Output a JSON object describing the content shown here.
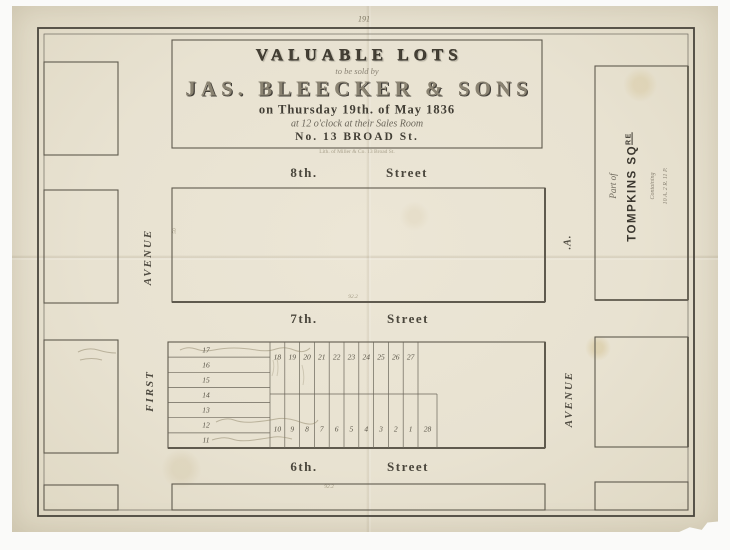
{
  "page_number": "191",
  "title_block": {
    "headline": "VALUABLE LOTS",
    "subline": "to be sold by",
    "auctioneer": "JAS. BLEECKER & SONS",
    "date_line": "on Thursday 19th. of May 1836",
    "time_line": "at 12 o'clock at their Sales Room",
    "address_line": "No. 13 BROAD St.",
    "imprint": "Lith. of Miller & Co. 13 Broad St."
  },
  "streets": {
    "s8": {
      "ordinal": "8th.",
      "word": "Street"
    },
    "s7": {
      "ordinal": "7th.",
      "word": "Street"
    },
    "s6": {
      "ordinal": "6th.",
      "word": "Street"
    }
  },
  "avenues": {
    "first_name": "FIRST",
    "first_word": "AVENUE",
    "a_word": "AVENUE",
    "a_name": ".A."
  },
  "square": {
    "part_of": "Part of",
    "name": "TOMPKINS SQ",
    "name_sup": "RE",
    "containing": "Containing",
    "area": "10 A. 2 R. 11 P."
  },
  "lots": {
    "west_column": [
      "17",
      "16",
      "15",
      "14",
      "13",
      "12",
      "11"
    ],
    "north_row": [
      "18",
      "19",
      "20",
      "21",
      "22",
      "23",
      "24",
      "25",
      "26",
      "27"
    ],
    "south_row": [
      "10",
      "9",
      "8",
      "7",
      "6",
      "5",
      "4",
      "3",
      "2",
      "1"
    ],
    "corner_lot": "28"
  },
  "dimensions": {
    "block_width_top": "92.2",
    "block_width_bottom": "92.2",
    "lot_depth": "50"
  }
}
